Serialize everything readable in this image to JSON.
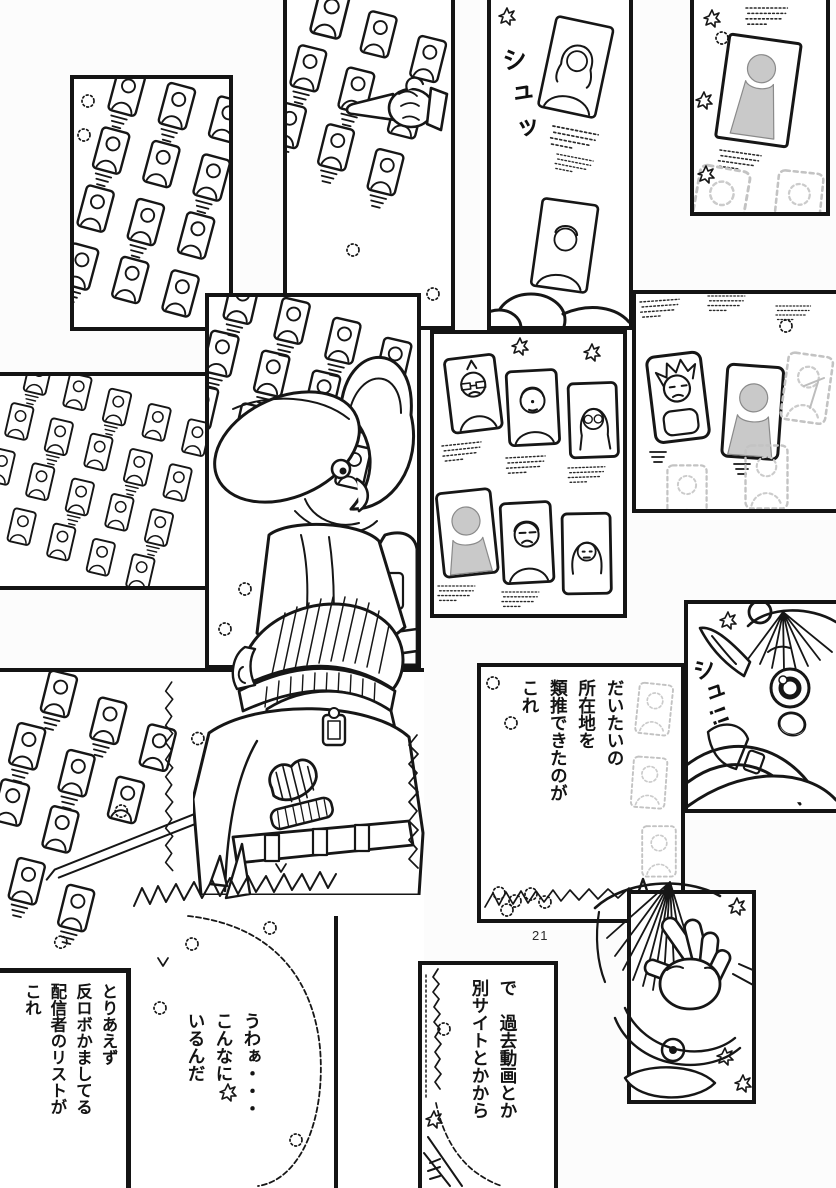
{
  "page": {
    "number": "21"
  },
  "colors": {
    "ink": "#141414",
    "tone_gray": "#c9c9c9",
    "paper": "#ffffff"
  },
  "sfx": {
    "whoosh_small": "シュッ",
    "whoosh_loud": "シュ!!"
  },
  "speech": {
    "deduce_location": "だいたいの\n所在地を\n類推できたのが\nこれ",
    "other_sites": "で　過去動画とか\n別サイトとかから",
    "streamer_list": "とりあえず\n反ロボかましてる\n配信者のリストが\nこれ",
    "so_many": "うわぁ・・・\nこんなに\nいるんだ"
  }
}
